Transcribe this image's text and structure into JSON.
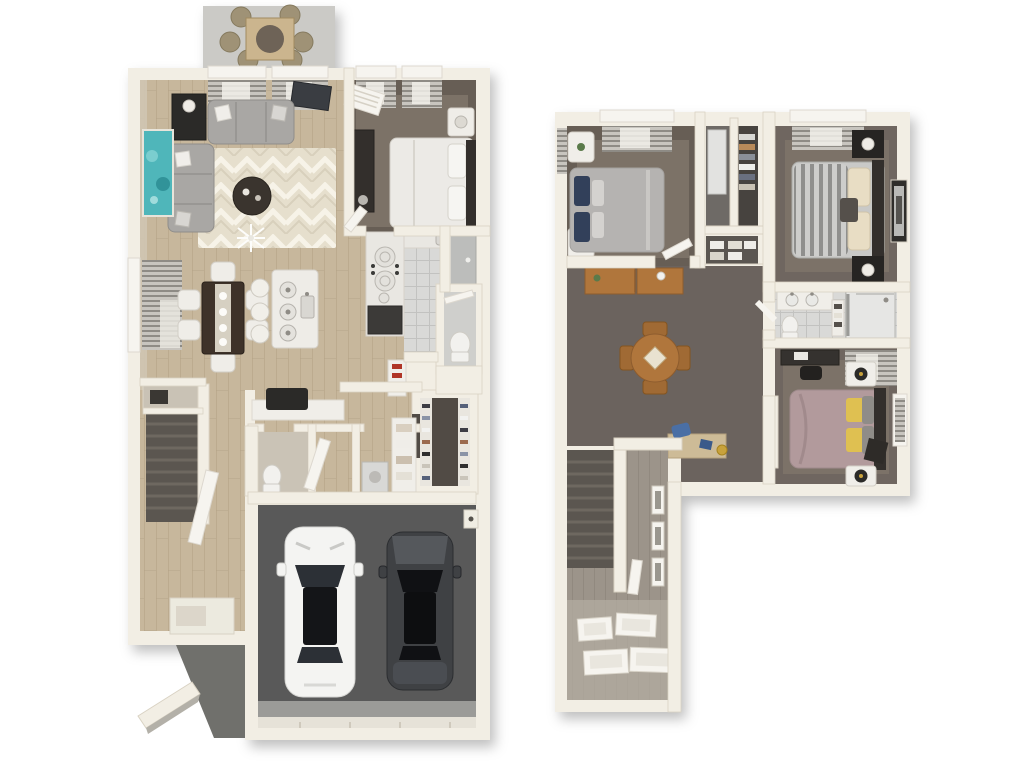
{
  "scene": {
    "type": "3d-floor-plan-render",
    "views": [
      {
        "name": "first-floor",
        "rooms": [
          "patio",
          "living-room",
          "bedroom",
          "bathroom",
          "kitchen",
          "dining-area",
          "pantry",
          "walk-in-closet",
          "powder-room",
          "laundry",
          "entry-foyer",
          "stairs",
          "front-porch",
          "two-car-garage"
        ],
        "furniture": [
          "outdoor-dining-set",
          "sectional-sofa",
          "coffee-table",
          "console-lamp",
          "wall-art",
          "tv",
          "dining-table-6-chairs",
          "kitchen-island-stools",
          "cooktop",
          "refrigerator",
          "toilet",
          "shower",
          "shoe-shelves",
          "desk-chair",
          "washer",
          "white-car",
          "black-car"
        ]
      },
      {
        "name": "second-floor",
        "rooms": [
          "bedroom-2",
          "hall-closets",
          "linen-closet",
          "bedroom-3",
          "bathroom-2",
          "bedroom-4",
          "loft",
          "hallway",
          "stairwell"
        ],
        "furniture": [
          "bed-gray-navy-pillows",
          "bed-striped-duvet",
          "bed-mauve-yellow-pillows",
          "nightstands",
          "dressers",
          "round-table-4-chairs",
          "study-desk",
          "vanity",
          "toilet",
          "shower",
          "wall-frames"
        ]
      }
    ]
  },
  "palette": {
    "wall": "#f2eee4",
    "wall_edge": "#d9d2c3",
    "beige_face": "#cfc5b2",
    "wood_base": "#c7b79c",
    "wood_line": "#b2a084",
    "gwood_base": "#9c948a",
    "gwood_line": "#8a8277",
    "rug_base": "#e6dfcd",
    "rug_zig": "#f7f3e8",
    "tile_base": "#d9d9d7",
    "tile_line": "#c2c2c0",
    "blind_base": "#c8c5bf",
    "blind_line": "#8e8b85",
    "carpet_wall": "#675e55",
    "carpet": "#7c7267",
    "loft_carpet": "#6b635e",
    "garage": "#595959",
    "garage_apron": "#9b9b98",
    "patio": "#cbcac6",
    "porch": "#70706c",
    "sofa": "#a9a7a4",
    "coffee_table": "#3a342e",
    "art_teal": "#4fb6ba",
    "dining_table": "#3e3229",
    "chair_white": "#efede8",
    "island": "#eeece7",
    "counter": "#e9e7e2",
    "fridge": "#3c3a38",
    "bed_white": "#eceae6",
    "bed_gray": "#b5b3b1",
    "pillow_navy": "#32405a",
    "stripe_base": "#cdcdcb",
    "stripe_line": "#8f8f8d",
    "pillow_cream": "#e8ddc4",
    "bed_mauve": "#b29a9c",
    "pillow_yellow": "#dfc051",
    "headboard_dark": "#332f2c",
    "wood_furniture": "#b0763c",
    "car_white": "#f4f4f2",
    "car_dark": "#3f4144",
    "glass_dark": "#141518",
    "stairs_dark": "#5b5650",
    "frame_white": "#f6f4ef",
    "closet_dark": "#514b45",
    "shelf_white": "#f0eee9",
    "toilet_white": "#f2f1ee",
    "shower_tile": "#bcbdbb",
    "appliance": "#d8d8d6",
    "accent_red": "#b03527",
    "chair_blue": "#4a6fa5",
    "lamp_gold": "#c8a23c",
    "plant_green": "#5a7a4a",
    "dark_item": "#2b2a28",
    "tv": "#3a3d42"
  }
}
